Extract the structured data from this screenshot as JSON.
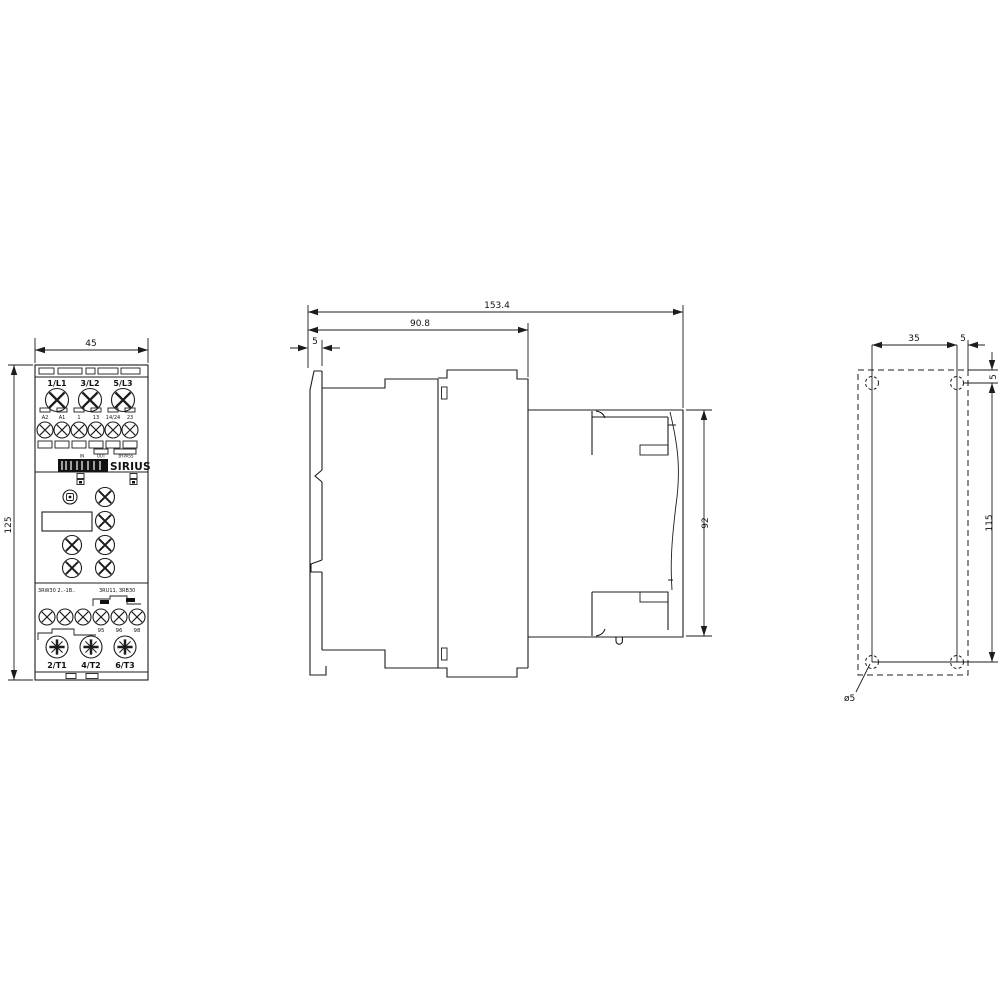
{
  "front_view": {
    "dim_width": "45",
    "dim_height": "125",
    "line_terminals": [
      "1/L1",
      "3/L2",
      "5/L3"
    ],
    "control_terminals": [
      "A2",
      "A1",
      "1",
      "13",
      "14/24",
      "23"
    ],
    "markings": [
      "IN",
      "OUT",
      "BYPASS"
    ],
    "brand": "SIRIUS",
    "type_text": "3RW30 2..-1B..",
    "side_text": "3RU11, 3RB30",
    "aux_terminals": [
      "95",
      "96",
      "98"
    ],
    "output_terminals": [
      "2/T1",
      "4/T2",
      "6/T3"
    ]
  },
  "side_view": {
    "dim_depth_total": "153.4",
    "dim_depth_body": "90.8",
    "dim_front_tab": "5",
    "dim_terminal_height": "92"
  },
  "rear_view": {
    "dim_hole_spacing_horizontal": "35",
    "dim_hole_to_edge_horizontal": "5",
    "dim_hole_to_edge_vertical": "5",
    "dim_hole_spacing_vertical": "115",
    "hole_diameter": "ø5"
  }
}
